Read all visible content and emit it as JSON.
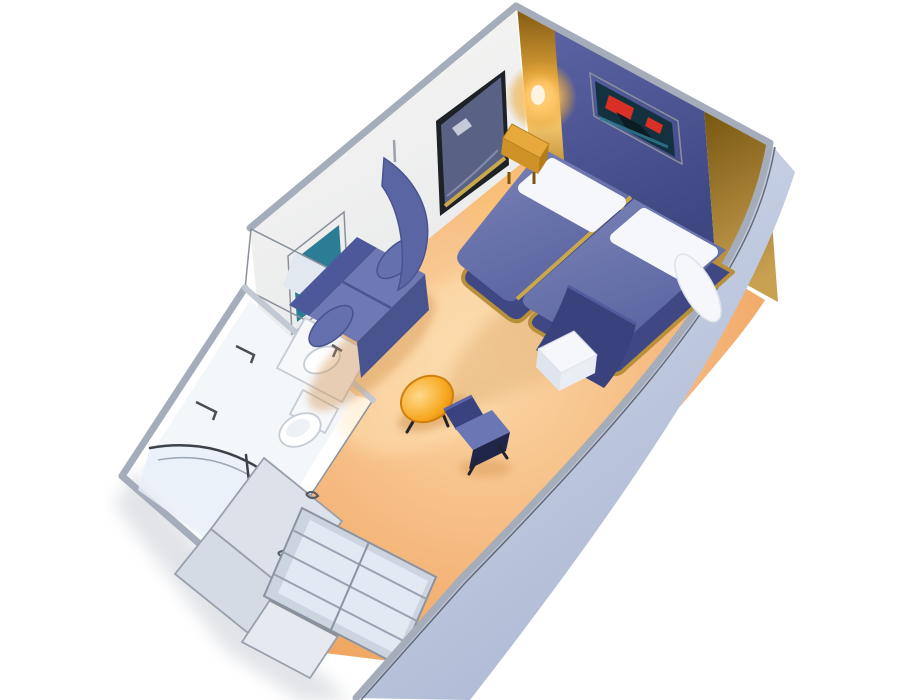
{
  "scene": {
    "kind": "isometric-cutaway-floorplan",
    "subject": "cruise-ship interior stateroom",
    "background": "#ffffff"
  },
  "labels": {
    "scene": "3D cutaway plan of an interior stateroom",
    "floor": "carpet floor",
    "left_wall": "forward interior wall",
    "accent_wall": "bed headboard accent wall",
    "gold_column": "gold corner column",
    "gold_panel": "gold corner panel",
    "exterior_wall": "cabin side wall",
    "mirror": "wall mirror",
    "wall_lamp": "wall sconce lamp",
    "artwork_bed": "framed artwork above beds",
    "artwork_sofa": "framed artwork above sofa",
    "bed_left": "twin bed (left)",
    "bed_right": "twin bed (right)",
    "pillow": "pillow",
    "bolster": "white bolster",
    "foot_throw": "navy throw at bed foot",
    "bench": "white bench at bed foot",
    "nightstand": "gold nightstand",
    "sofa": "blue loveseat sofa",
    "curtain": "divider curtain",
    "coffee_table": "oval coffee table",
    "chair": "desk chair",
    "bathroom": "bathroom",
    "vanity": "vanity area",
    "shower": "curved shower enclosure",
    "toilet": "toilet",
    "sink": "sink counter",
    "towel_rail": "towel rail",
    "wardrobe": "wardrobe doors",
    "shelf_unit": "closet shelf unit",
    "entry_door": "entry door"
  },
  "palette": {
    "background": "#ffffff",
    "floor_light": "#fbd7a6",
    "floor_mid": "#f4b478",
    "floor_deep": "#eb9a4e",
    "floor_glow": "#ffe6ba",
    "lamp_warm": "#ffc566",
    "wall_white": "#f7f7f5",
    "wall_white_shade": "#e8e9ea",
    "accent_top": "#5b63a4",
    "accent_bottom": "#3e4781",
    "gold_dark": "#7c5510",
    "gold_mid": "#e8a93c",
    "gold_light": "#ffd27a",
    "gold_deep": "#a9761a",
    "panel_top": "#76550f",
    "panel_bottom": "#c9a152",
    "ext_light": "#d9e0ee",
    "ext_mid": "#aab6d2",
    "bed_light": "#7b84b8",
    "bed_dark": "#5a64a0",
    "bed_base": "#3f4883",
    "pillow": "#f5f7fa",
    "navy": "#39427c",
    "sofa_back": "#4d589a",
    "sofa_seat": "#6d78b4",
    "sofa_skirt": "#49538e",
    "sofa_arm": "#6570ae",
    "curtain": "#5a66a4",
    "table_center": "#ffd98c",
    "table_mid": "#f7a81f",
    "table_rim": "#e08a0e",
    "chair_back": "#3a4380",
    "chair_seat": "#6b77b4",
    "chair_under": "#20264a",
    "bath_floor": "#edf1f6",
    "bath_inner": "#f4f7fa",
    "glass": "#e9eff7",
    "fixture_white": "#ffffff",
    "fixture_soft": "#f6f8fa",
    "mirror_glass": "#596284",
    "mirror_frame": "#1e2126",
    "vanity_panel": "#e2e8f0",
    "door_panel_a": "#dde2ea",
    "door_panel_b": "#d5dbe5",
    "shelf_face": "#ccd4e0",
    "shelf_inner": "#e3e9f2",
    "entry": "#e6eaf0",
    "art_teal": "#2a7d95",
    "art_dark": "#13313f",
    "art_red": "#d93025",
    "frame_gold": "#c9a84c",
    "shadow": "#c9cdd4",
    "warm_shadow": "#cf8f4c"
  }
}
